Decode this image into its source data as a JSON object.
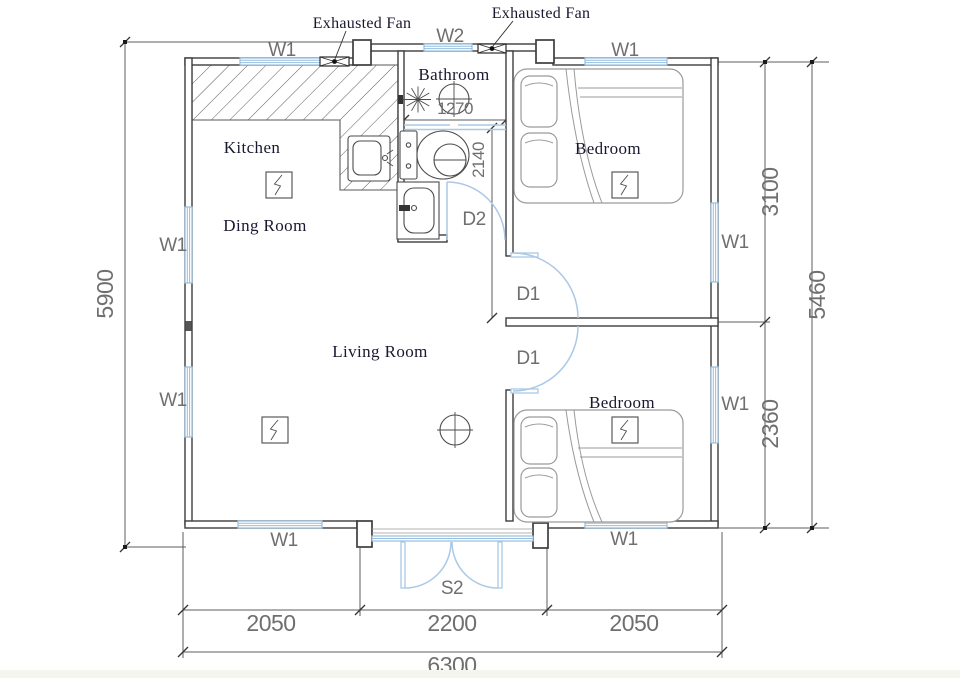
{
  "colors": {
    "wall": "#3d3d3d",
    "window": "#97bedf",
    "door": "#abc9e6",
    "dim": "#5c5c5c",
    "dimtext": "#6f6f6f",
    "roomtext": "#181830",
    "furniture": "#9a9a9a",
    "fixture": "#4b4b4b"
  },
  "rooms": {
    "kitchen": "Kitchen",
    "dining": "Ding Room",
    "living": "Living Room",
    "bathroom": "Bathroom",
    "bedroom_top": "Bedroom",
    "bedroom_bottom": "Bedroom"
  },
  "annotations": {
    "exhaust_fan_left": "Exhausted Fan",
    "exhaust_fan_right": "Exhausted Fan"
  },
  "openings": {
    "window_w1": "W1",
    "window_w2": "W2",
    "door_d1": "D1",
    "door_d2": "D2",
    "door_s2": "S2"
  },
  "dimensions": {
    "left_total": "5900",
    "right_upper": "3100",
    "right_lower": "2360",
    "right_total": "5460",
    "bath_width": "1270",
    "bath_height": "2140",
    "bottom_segments": [
      "2050",
      "2200",
      "2050"
    ],
    "bottom_total": "6300"
  }
}
